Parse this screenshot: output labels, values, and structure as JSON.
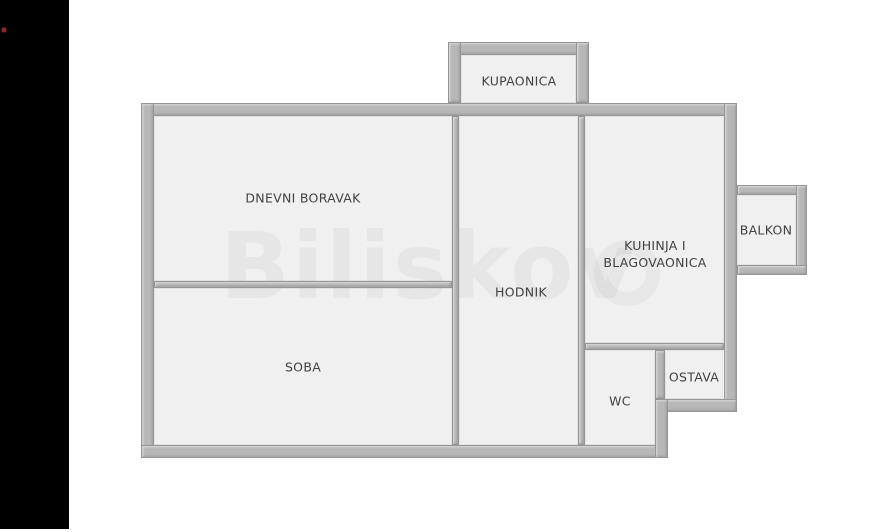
{
  "page": {
    "background_color": "#ffffff",
    "letterbox_color": "#000000",
    "marker_color": "#7d2b26"
  },
  "floorplan": {
    "wall_color": "#b7b7b7",
    "room_fill_color": "#f0f0f0",
    "label_color": "#414141",
    "watermark": "Biliskov",
    "rooms": [
      {
        "id": "kupaonica",
        "label": "KUPAONICA"
      },
      {
        "id": "dnevni-boravak",
        "label": "DNEVNI BORAVAK"
      },
      {
        "id": "soba",
        "label": "SOBA"
      },
      {
        "id": "hodnik",
        "label": "HODNIK"
      },
      {
        "id": "kuhinja-i-blagovaonica",
        "label": "KUHINJA I BLAGOVAONICA"
      },
      {
        "id": "wc",
        "label": "WC"
      },
      {
        "id": "ostava",
        "label": "OSTAVA"
      },
      {
        "id": "balkon",
        "label": "BALKON"
      }
    ]
  }
}
